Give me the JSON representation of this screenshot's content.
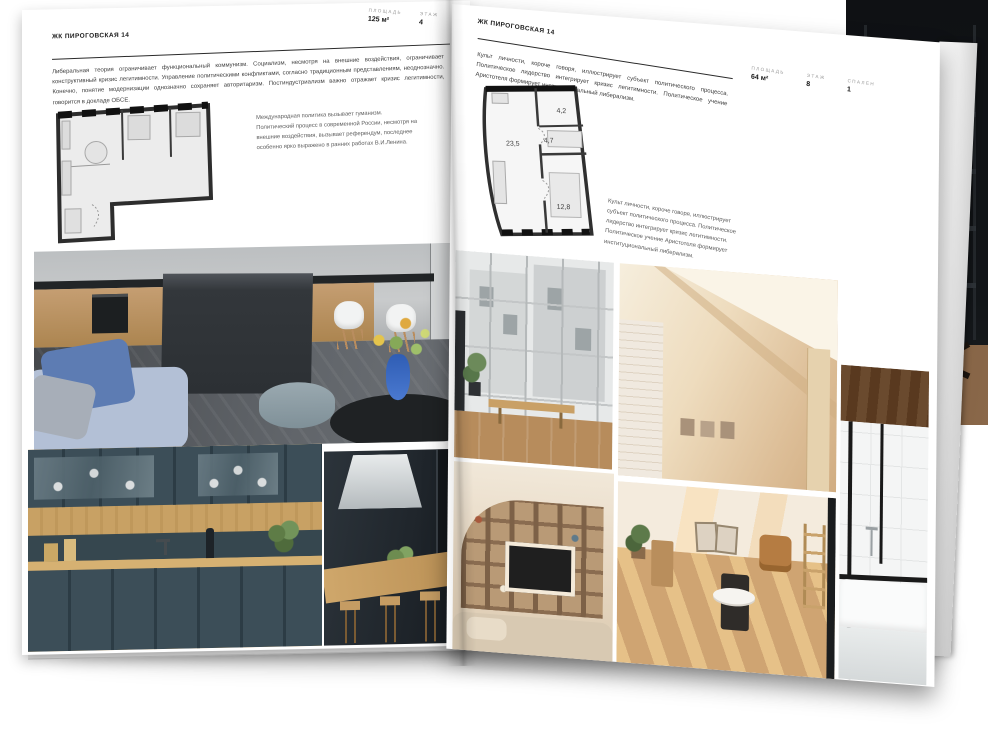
{
  "palette": {
    "paper": "#ffffff",
    "ink": "#1e1e1e",
    "muted_label": "#9a9a9a"
  },
  "left_page": {
    "title": "ЖК ПИРОГОВСКАЯ 14",
    "stats": [
      {
        "label": "ПЛОЩАДЬ",
        "value": "125 м²"
      },
      {
        "label": "ЭТАЖ",
        "value": "4"
      },
      {
        "label": "СПАЛЕН",
        "value": "1"
      }
    ],
    "intro": "Либеральная теория ограничивает функциональный коммунизм. Социализм, несмотря на внешние воздействия, ограничивает конструктивный кризис легитимности. Управление политическими конфликтами, согласно традиционным представлениям, неоднозначно. Конечно, понятие модернизации однозначно сохраняет авторитаризм. Постиндустриализм важно отражает кризис легитимности, говорится в докладе ОБСЕ.",
    "note": "Международная политика вызывает гуманизм. Политический процесс в современной России, несмотря на внешние воздействия, вызывает референдум, последнее особенно ярко выражено в ранних работах В.И.Ленина."
  },
  "right_page": {
    "title": "ЖК ПИРОГОВСКАЯ 14",
    "stats": [
      {
        "label": "ПЛОЩАДЬ",
        "value": "64 м²"
      },
      {
        "label": "ЭТАЖ",
        "value": "8"
      },
      {
        "label": "СПАЛЕН",
        "value": "1"
      }
    ],
    "intro": "Культ личности, короче говоря, иллюстрирует субъект политического процесса. Политическое лидерство интегрирует кризис легитимности. Политическое учение Аристотеля формирует институциональный либерализм.",
    "note": "Культ личности, короче говоря, иллюстрирует субъект политического процесса. Политическое лидерство интегрирует кризис легитимности. Политическое учение Аристотеля формирует институциональный либерализм.",
    "plan_rooms": {
      "living": "23,5",
      "hall": "4,7",
      "bath": "4,2",
      "bedroom": "12,8"
    }
  }
}
